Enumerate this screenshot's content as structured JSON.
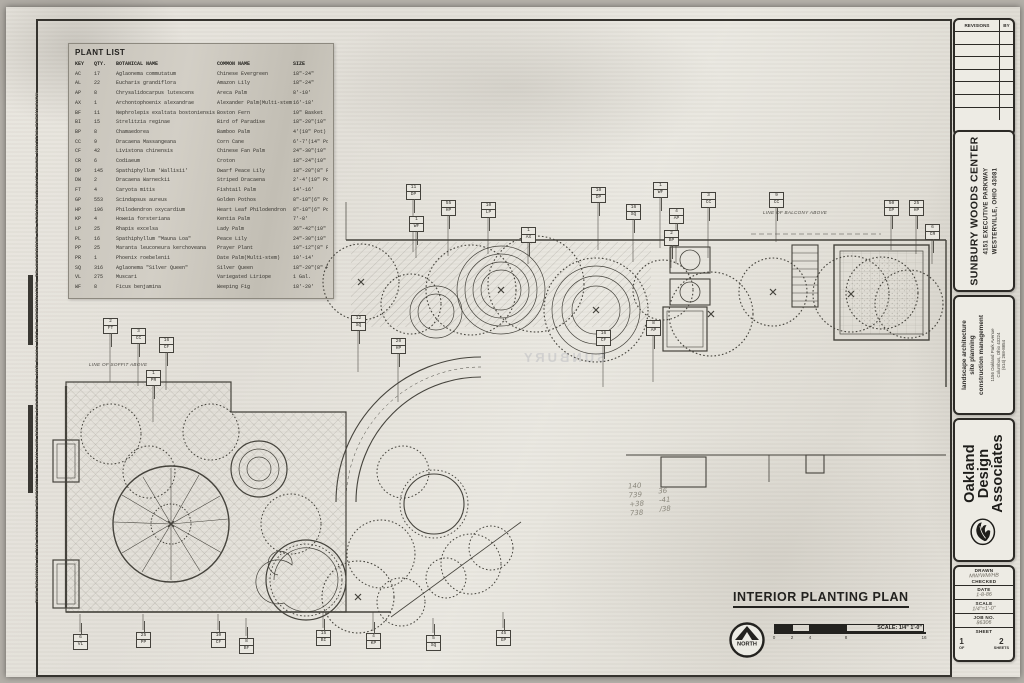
{
  "sheet": {
    "margin_note": "THIS DRAWING IS THE EXCLUSIVE PROPERTY OF OAKLAND DESIGN ASSOCIATES AND SHALL NOT BE REPRODUCED, TRANSFERRED OR COPIED WITHOUT PRIOR WRITTEN PERMISSION",
    "plan_title": "INTERIOR PLANTING PLAN",
    "north_label": "NORTH",
    "scale_label": "SCALE: 1/4\"  1'-0\"",
    "scale_ticks": [
      "0",
      "2",
      "4",
      "8",
      "16"
    ]
  },
  "plant_list": {
    "title": "PLANT LIST",
    "headers": [
      "KEY",
      "QTY.",
      "BOTANICAL NAME",
      "COMMON NAME",
      "SIZE"
    ],
    "rows": [
      [
        "AC",
        "17",
        "Aglaonema commutatum",
        "Chinese Evergreen",
        "18\"-24\""
      ],
      [
        "AL",
        "22",
        "Eucharis grandiflora",
        "Amazon Lily",
        "18\"-24\""
      ],
      [
        "AP",
        "8",
        "Chrysalidocarpus lutescens",
        "Areca Palm",
        "8'-10'"
      ],
      [
        "AX",
        "1",
        "Archontophoenix alexandrae",
        "Alexander Palm(Multi-stem)",
        "16'-18'"
      ],
      [
        "BF",
        "11",
        "Nephrolepis exaltata bostoniensis",
        "Boston Fern",
        "10\" Basket"
      ],
      [
        "BI",
        "15",
        "Strelitzia reginae",
        "Bird of Paradise",
        "18\"-20\"(10\" Pot)"
      ],
      [
        "BP",
        "8",
        "Chamaedorea",
        "Bamboo Palm",
        "4'(10\" Pot)"
      ],
      [
        "CC",
        "9",
        "Dracaena Massangeana",
        "Corn Cane",
        "6'-7'(14\" Pot)"
      ],
      [
        "CF",
        "42",
        "Livistona chinensis",
        "Chinese Fan Palm",
        "24\"-30\"(10\" Pot)"
      ],
      [
        "CR",
        "6",
        "Codiaeum",
        "Croton",
        "18\"-24\"(10\" Pot)"
      ],
      [
        "DP",
        "145",
        "Spathiphyllum 'Wallisii'",
        "Dwarf Peace Lily",
        "18\"-20\"(8\" Pot)"
      ],
      [
        "DW",
        "2",
        "Dracaena Warneckii",
        "Striped Dracaena",
        "2'-4'(10\" Pot)"
      ],
      [
        "FT",
        "4",
        "Caryota mitis",
        "Fishtail Palm",
        "14'-16'"
      ],
      [
        "GP",
        "553",
        "Scindapsus aureus",
        "Golden Pothos",
        "8\"-10\"(6\" Pot)"
      ],
      [
        "HP",
        "196",
        "Philodendron oxycardium",
        "Heart Leaf Philodendron",
        "8\"-10\"(6\" Pot)"
      ],
      [
        "KP",
        "4",
        "Howeia forsteriana",
        "Kentia Palm",
        "7'-8'"
      ],
      [
        "LP",
        "25",
        "Rhapis excelsa",
        "Lady Palm",
        "36\"-42\"(10\" Pot)"
      ],
      [
        "PL",
        "16",
        "Spathiphyllum \"Mauna Loa\"",
        "Peace Lily",
        "24\"-30\"(10\" Pot)"
      ],
      [
        "PP",
        "25",
        "Maranta leuconeura kerchoveana",
        "Prayer Plant",
        "10\"-12\"(8\" Pot)"
      ],
      [
        "PR",
        "1",
        "Phoenix roebelenii",
        "Date Palm(Multi-stem)",
        "10'-14'"
      ],
      [
        "SQ",
        "316",
        "Aglaonema \"Silver Queen\"",
        "Silver Queen",
        "18\"-20\"(8\" Pot)"
      ],
      [
        "VL",
        "275",
        "Muscari",
        "Variegated Liriope",
        "1 Gal."
      ],
      [
        "WF",
        "8",
        "Ficus benjamina",
        "Weeping Fig",
        "18'-20'"
      ]
    ]
  },
  "plan": {
    "notes": [
      {
        "text": "LINE OF BALCONY ABOVE",
        "x": 712,
        "y": 38
      },
      {
        "text": "LINE OF SOFFIT ABOVE",
        "x": 38,
        "y": 190
      }
    ],
    "ghost_text": "SUNBURY",
    "pencil_notes": [
      {
        "x": 578,
        "y": 310,
        "lines": [
          "140",
          "739",
          "+38",
          "738"
        ]
      },
      {
        "x": 608,
        "y": 315,
        "lines": [
          "36",
          "-41",
          "/38"
        ]
      }
    ],
    "tags": [
      {
        "x": 355,
        "y": 12,
        "qty": "11",
        "key": "DP",
        "lead": "down"
      },
      {
        "x": 390,
        "y": 28,
        "qty": "55",
        "key": "HP",
        "lead": "down"
      },
      {
        "x": 358,
        "y": 44,
        "qty": "1",
        "key": "WF",
        "lead": "down"
      },
      {
        "x": 430,
        "y": 30,
        "qty": "10",
        "key": "LP",
        "lead": "down"
      },
      {
        "x": 470,
        "y": 55,
        "qty": "1",
        "key": "AX",
        "lead": "down"
      },
      {
        "x": 540,
        "y": 15,
        "qty": "10",
        "key": "DP",
        "lead": "down"
      },
      {
        "x": 575,
        "y": 32,
        "qty": "16",
        "key": "SQ",
        "lead": "down"
      },
      {
        "x": 602,
        "y": 10,
        "qty": "1",
        "key": "WF",
        "lead": "down"
      },
      {
        "x": 618,
        "y": 36,
        "qty": "4",
        "key": "AP",
        "lead": "down"
      },
      {
        "x": 613,
        "y": 58,
        "qty": "2",
        "key": "BP",
        "lead": "down"
      },
      {
        "x": 650,
        "y": 20,
        "qty": "3",
        "key": "CC",
        "lead": "down"
      },
      {
        "x": 718,
        "y": 20,
        "qty": "9",
        "key": "CC",
        "lead": "down"
      },
      {
        "x": 833,
        "y": 28,
        "qty": "50",
        "key": "GP",
        "lead": "down"
      },
      {
        "x": 858,
        "y": 28,
        "qty": "25",
        "key": "HP",
        "lead": "down"
      },
      {
        "x": 874,
        "y": 52,
        "qty": "6",
        "key": "CR",
        "lead": "down"
      },
      {
        "x": 52,
        "y": 146,
        "qty": "2",
        "key": "FT",
        "lead": "down"
      },
      {
        "x": 80,
        "y": 156,
        "qty": "3",
        "key": "CC",
        "lead": "down"
      },
      {
        "x": 108,
        "y": 165,
        "qty": "16",
        "key": "CF",
        "lead": "down"
      },
      {
        "x": 95,
        "y": 198,
        "qty": "1",
        "key": "PR",
        "lead": "down"
      },
      {
        "x": 300,
        "y": 143,
        "qty": "12",
        "key": "SQ",
        "lead": "down"
      },
      {
        "x": 340,
        "y": 166,
        "qty": "20",
        "key": "HP",
        "lead": "down"
      },
      {
        "x": 545,
        "y": 158,
        "qty": "16",
        "key": "CF",
        "lead": "down"
      },
      {
        "x": 595,
        "y": 148,
        "qty": "8",
        "key": "AP",
        "lead": "down"
      },
      {
        "x": 22,
        "y": 462,
        "qty": "6",
        "key": "VL",
        "lead": "up"
      },
      {
        "x": 85,
        "y": 460,
        "qty": "25",
        "key": "PP",
        "lead": "up"
      },
      {
        "x": 160,
        "y": 460,
        "qty": "10",
        "key": "CF",
        "lead": "up"
      },
      {
        "x": 188,
        "y": 466,
        "qty": "8",
        "key": "BF",
        "lead": "up"
      },
      {
        "x": 265,
        "y": 458,
        "qty": "15",
        "key": "BI",
        "lead": "up"
      },
      {
        "x": 315,
        "y": 461,
        "qty": "4",
        "key": "KP",
        "lead": "up"
      },
      {
        "x": 375,
        "y": 463,
        "qty": "5",
        "key": "SQ",
        "lead": "up"
      },
      {
        "x": 445,
        "y": 458,
        "qty": "45",
        "key": "GP",
        "lead": "up"
      }
    ]
  },
  "titleblock": {
    "revisions": {
      "header": "REVISIONS",
      "by": "BY",
      "empty_rows": 7
    },
    "project": {
      "name": "SUNBURY WOODS CENTER",
      "address1": "4151 EXECUTIVE PARKWAY",
      "address2": "WESTERVILLE, OHIO 43081"
    },
    "firm": {
      "services": [
        "landscape architecture",
        "site planning",
        "construction management"
      ],
      "address": [
        "1156 Oakland Park Avenue",
        "Columbus, Ohio 43224",
        "(614) 268-8854"
      ],
      "name_lines": [
        "Oakland",
        "Design",
        "Associates"
      ]
    },
    "fields": {
      "drawn_label": "DRAWN",
      "drawn_value": "MW/WM/HB",
      "checked_label": "CHECKED",
      "checked_value": "",
      "date_label": "DATE",
      "date_value": "1-8-86",
      "scale_label": "SCALE",
      "scale_value": "1/4\"=1'-0\"",
      "job_label": "JOB NO.",
      "job_value": "86306",
      "sheet_label": "SHEET",
      "sheet_num": "1",
      "sheet_of": "OF",
      "sheet_total": "2",
      "sheets_label": "SHEETS"
    }
  }
}
